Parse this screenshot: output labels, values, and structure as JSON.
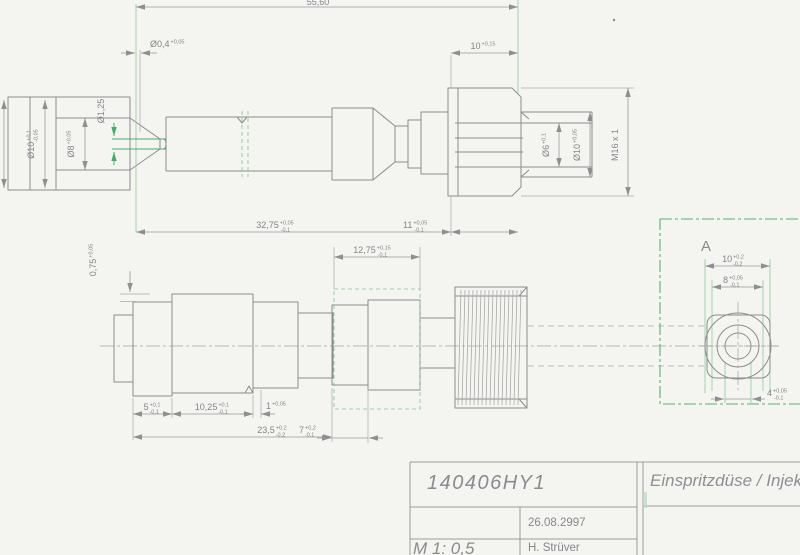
{
  "drawing": {
    "title_block": {
      "part_number": "140406HY1",
      "title": "Einspritzdüse / Injektor",
      "date": "26.08.2997",
      "scale": "M 1: 0,5",
      "author": "H. Strüver"
    },
    "detail_label": "A",
    "dims": {
      "total": {
        "v": "55,60"
      },
      "hole": {
        "v": "Ø0,4",
        "up": "+0,05"
      },
      "len10": {
        "v": "10",
        "up": "+0,15"
      },
      "d10l": {
        "v": "Ø10",
        "up": "+0,1",
        "dn": "-0,05"
      },
      "d8": {
        "v": "Ø8",
        "up": "+0,05"
      },
      "d125": {
        "v": "Ø1,25"
      },
      "d6": {
        "v": "Ø6",
        "up": "+0,1"
      },
      "d10r": {
        "v": "Ø10",
        "up": "+0,05"
      },
      "m16": {
        "v": "M16 x 1"
      },
      "l3275": {
        "v": "32,75",
        "up": "+0,05",
        "dn": "-0,1"
      },
      "l11": {
        "v": "11",
        "up": "+0,05",
        "dn": "-0,1"
      },
      "l1275": {
        "v": "12,75",
        "up": "+0,15",
        "dn": "-0,1"
      },
      "s075": {
        "v": "0,75",
        "up": "+0,05"
      },
      "l5": {
        "v": "5",
        "up": "+0,1",
        "dn": "-0,1"
      },
      "l1025": {
        "v": "10,25",
        "up": "+0,1",
        "dn": "-0,1"
      },
      "l1": {
        "v": "1",
        "up": "+0,05"
      },
      "l235": {
        "v": "23,5",
        "up": "+0,2",
        "dn": "-0,2"
      },
      "l7": {
        "v": "7",
        "up": "+0,2",
        "dn": "-0,1"
      },
      "a10": {
        "v": "10",
        "up": "+0,2",
        "dn": "-0,2"
      },
      "a8": {
        "v": "8",
        "up": "+0,05",
        "dn": "-0,1"
      },
      "a4": {
        "v": "4",
        "up": "+0,05",
        "dn": "-0,1"
      }
    },
    "colors": {
      "bg": "#f4f4f1",
      "line": "#8d8d8d",
      "text": "#85858a",
      "green": "#3fae6a",
      "pale_green": "#9ccfa9"
    }
  }
}
